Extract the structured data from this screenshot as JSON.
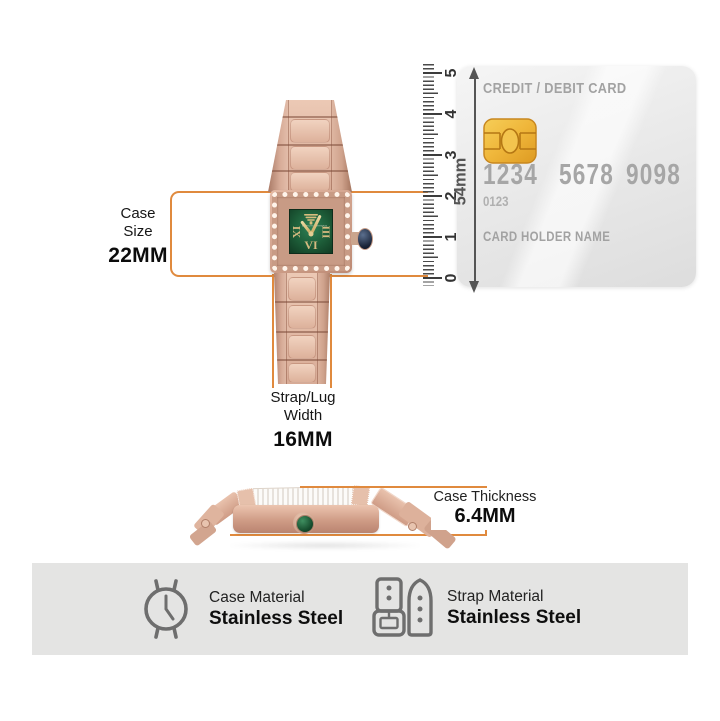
{
  "colors": {
    "accent_orange": "#E08A3E",
    "dial_green": "#1D5C38",
    "rose_gold": "#D3A18C",
    "chip_gold": "#F0B63C",
    "band_background": "#E4E4E3",
    "icon_gray": "#6E6E6E",
    "card_text_gray": "#A6A6A6"
  },
  "watch_front": {
    "brand": "EMPORIO ARMANI",
    "numeral_left": "IX",
    "numeral_right": "III",
    "numeral_bottom": "VI"
  },
  "annotations": {
    "case_size": {
      "line1": "Case",
      "line2": "Size",
      "value": "22MM"
    },
    "strap_width": {
      "line1": "Strap/Lug",
      "line2": "Width",
      "value": "16MM"
    },
    "case_thickness": {
      "label": "Case Thickness",
      "value": "6.4MM"
    }
  },
  "ruler": {
    "numbers": [
      "0",
      "1",
      "2",
      "3",
      "4",
      "5"
    ],
    "span_label": "54mm"
  },
  "credit_card": {
    "title": "CREDIT / DEBIT CARD",
    "number_groups": [
      "1234",
      "5678",
      "9098"
    ],
    "sub_number": "0123",
    "holder_label": "CARD HOLDER NAME"
  },
  "materials": {
    "case": {
      "label": "Case Material",
      "value": "Stainless Steel"
    },
    "strap": {
      "label": "Strap Material",
      "value": "Stainless Steel"
    }
  }
}
